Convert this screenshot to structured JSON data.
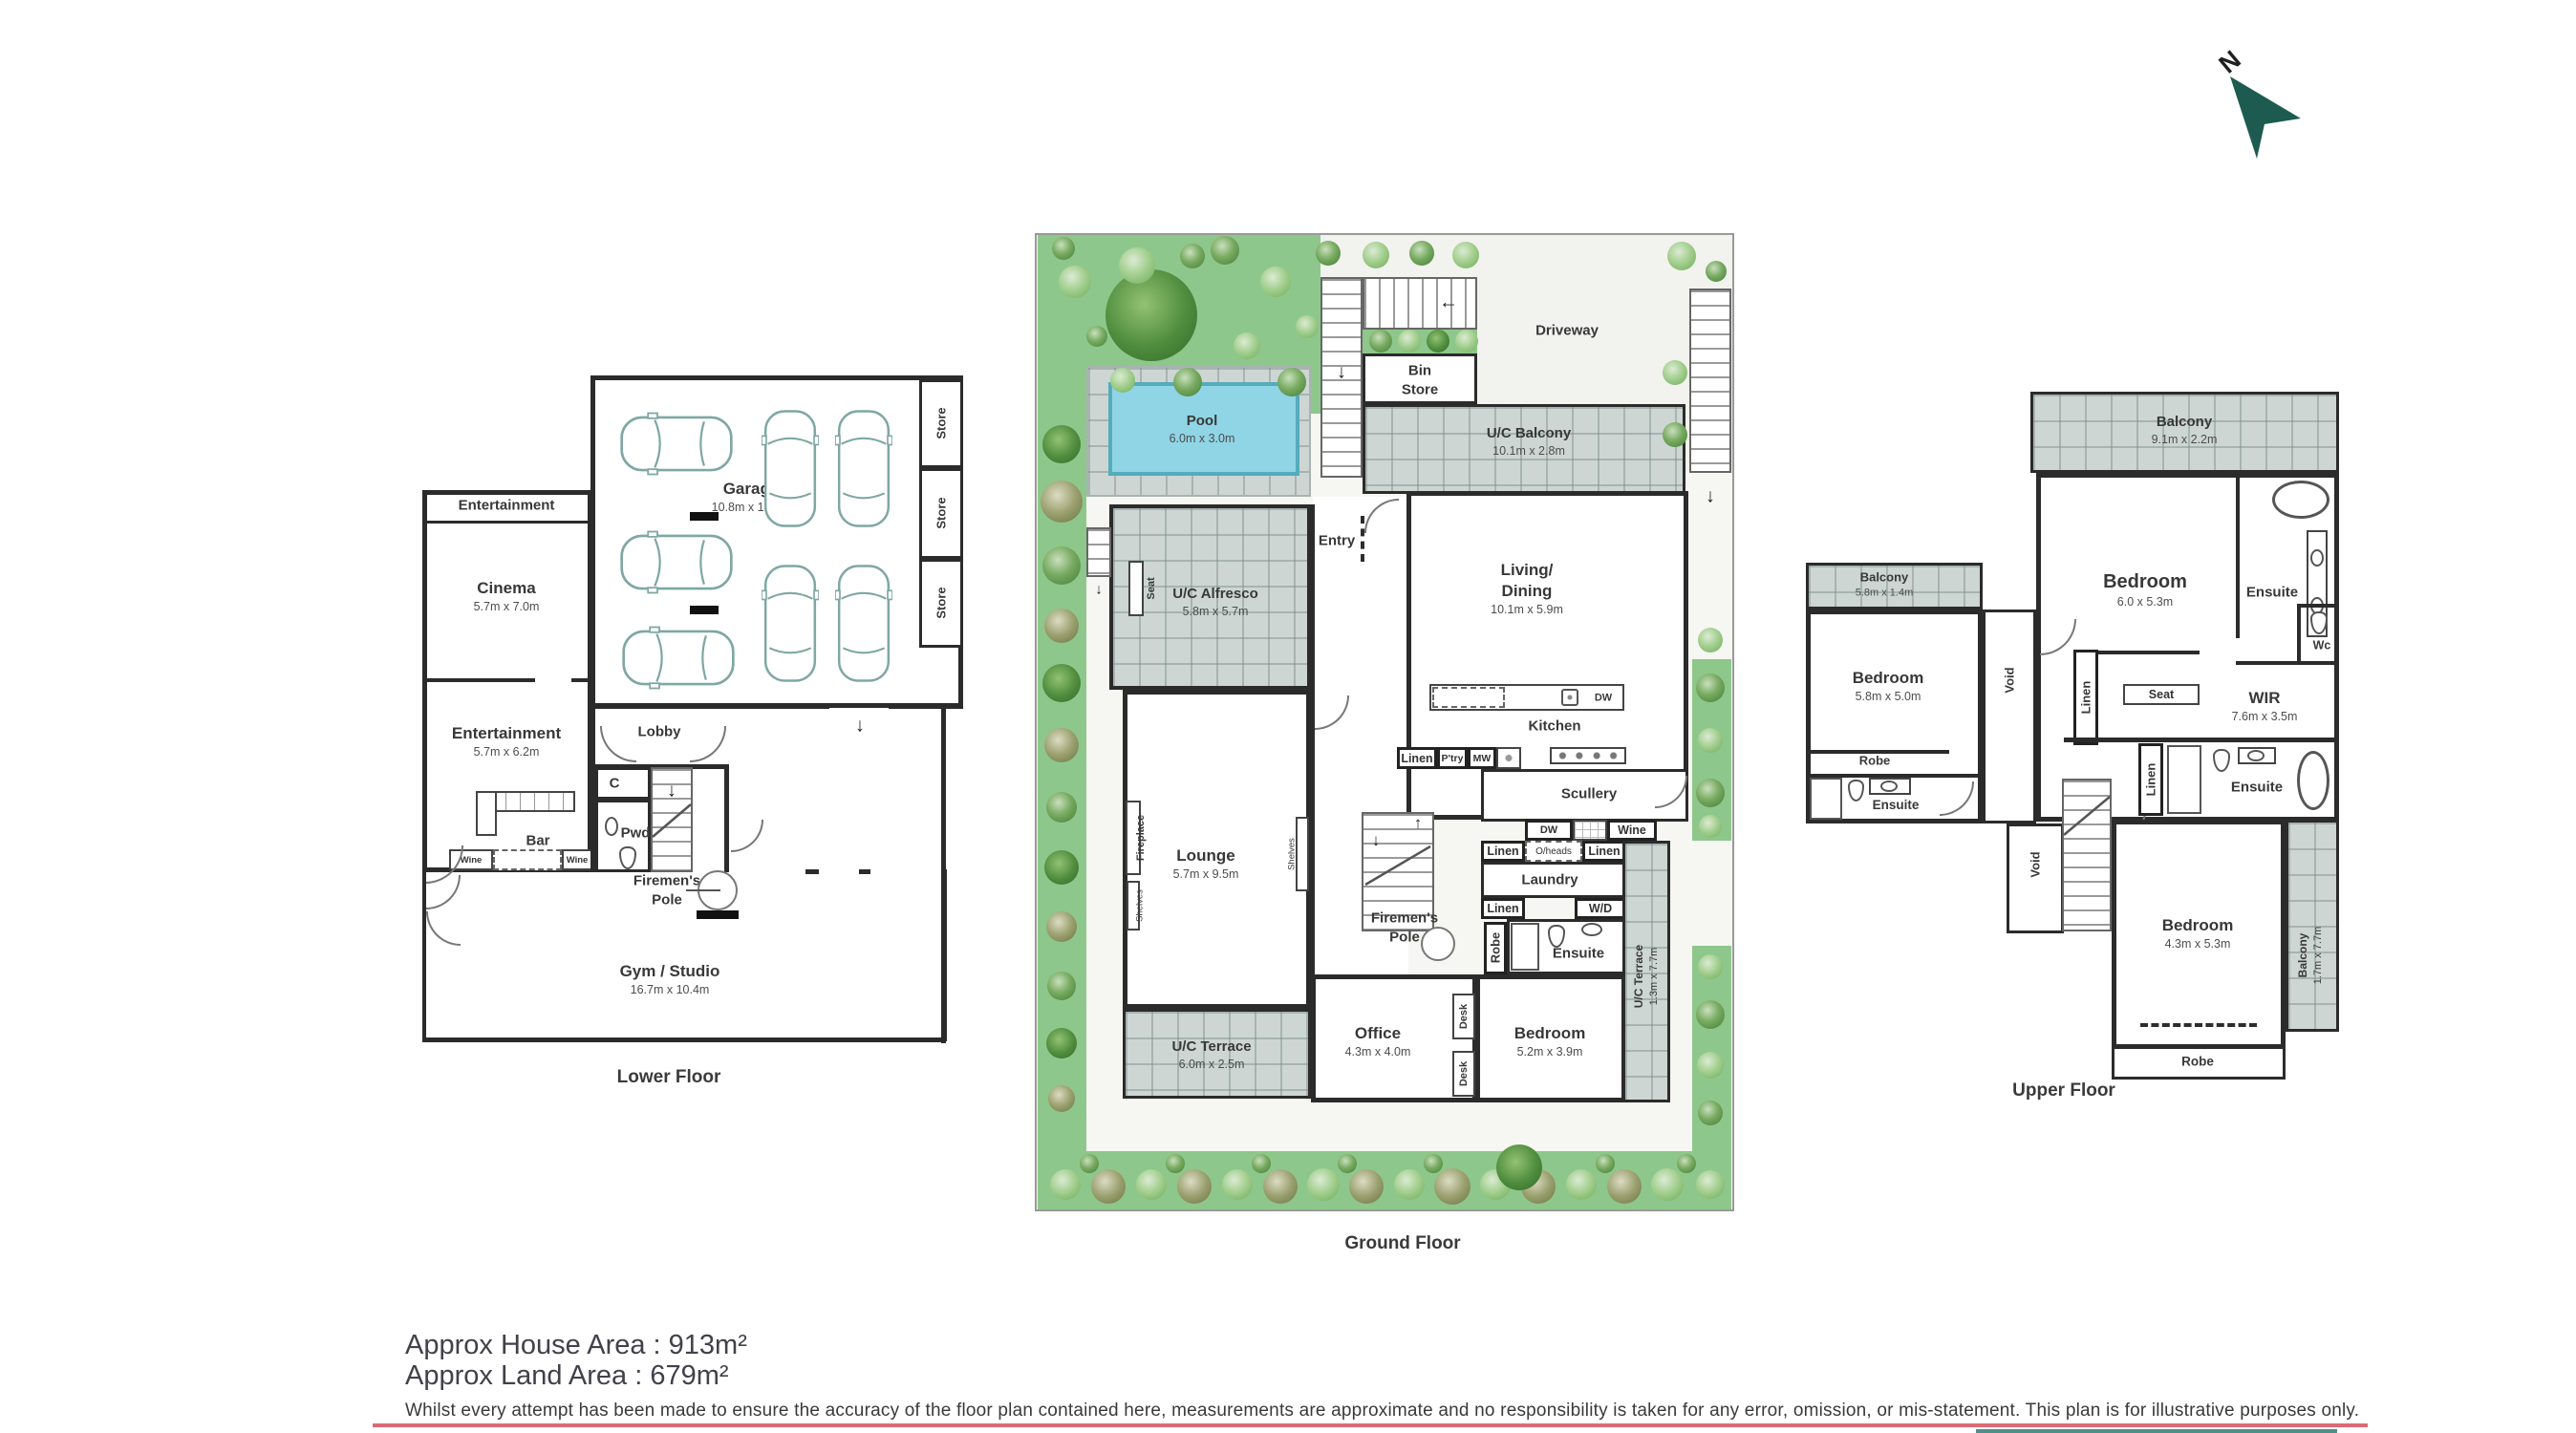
{
  "north_arrow": {
    "letter": "N",
    "color": "#1d5b50"
  },
  "lower_floor": {
    "caption": "Lower Floor",
    "entertainment_upper": {
      "name": "Entertainment"
    },
    "cinema": {
      "name": "Cinema",
      "dims": "5.7m x 7.0m"
    },
    "garage": {
      "name": "Garage",
      "dims": "10.8m x 10.6m"
    },
    "store": "Store",
    "lobby": "Lobby",
    "closet": "C",
    "powder": "Pwd",
    "bar": "Bar",
    "wine": "Wine",
    "entertainment_lower": {
      "name": "Entertainment",
      "dims": "5.7m x 6.2m"
    },
    "firemens_pole": "Firemen's Pole",
    "gym": {
      "name": "Gym / Studio",
      "dims": "16.7m x 10.4m"
    }
  },
  "ground_floor": {
    "caption": "Ground Floor",
    "driveway": "Driveway",
    "bin_store": "Bin Store",
    "pool": {
      "name": "Pool",
      "dims": "6.0m x 3.0m"
    },
    "uc_balcony": {
      "name": "U/C Balcony",
      "dims": "10.1m x 2.8m"
    },
    "entry": "Entry",
    "seat": "Seat",
    "uc_alfresco": {
      "name": "U/C Alfresco",
      "dims": "5.8m x 5.7m"
    },
    "living_dining": {
      "name": "Living/ Dining",
      "dims": "10.1m x 5.9m"
    },
    "kitchen": "Kitchen",
    "linen": "Linen",
    "pantry": "P'try",
    "microwave": "MW",
    "dishwasher": "DW",
    "scullery": "Scullery",
    "wine": "Wine",
    "overheads": "O/heads",
    "laundry": "Laundry",
    "washer_dryer": "W/D",
    "robe": "Robe",
    "ensuite": "Ensuite",
    "firemens_pole": "Firemen's Pole",
    "lounge": {
      "name": "Lounge",
      "dims": "5.7m x 9.5m"
    },
    "fireplace": "Fireplace",
    "shelves": "Shelves",
    "uc_terrace": {
      "name": "U/C Terrace",
      "dims": "6.0m x 2.5m"
    },
    "office": {
      "name": "Office",
      "dims": "4.3m x 4.0m"
    },
    "desk": "Desk",
    "bedroom": {
      "name": "Bedroom",
      "dims": "5.2m x 3.9m"
    },
    "uc_terrace_side": {
      "name": "U/C Terrace",
      "dims": "1.3m x 7.7m"
    }
  },
  "upper_floor": {
    "caption": "Upper Floor",
    "balcony_rear": {
      "name": "Balcony",
      "dims": "9.1m x 2.2m"
    },
    "bedroom_master": {
      "name": "Bedroom",
      "dims": "6.0 x 5.3m"
    },
    "ensuite": "Ensuite",
    "wc": "Wc",
    "wir": {
      "name": "WIR",
      "dims": "7.6m x 3.5m"
    },
    "seat": "Seat",
    "linen": "Linen",
    "void": "Void",
    "balcony_left": {
      "name": "Balcony",
      "dims": "5.8m x 1.4m"
    },
    "bedroom_2": {
      "name": "Bedroom",
      "dims": "5.8m x 5.0m"
    },
    "robe": "Robe",
    "bedroom_3": {
      "name": "Bedroom",
      "dims": "4.3m x 5.3m"
    },
    "balcony_side": {
      "name": "Balcony",
      "dims": "1.7m x 7.7m"
    }
  },
  "footer": {
    "house_area": "Approx House Area : 913m²",
    "land_area": "Approx Land Area : 679m²",
    "disclaimer": "Whilst every attempt has been made to ensure the accuracy of the floor plan contained here, measurements are approximate and no responsibility is taken for any error, omission, or mis-statement. This plan is for illustrative purposes only."
  },
  "colors": {
    "wall": "#2b2b2b",
    "garden": "#8ec78b",
    "tile": "#cdd6d3",
    "pool": "#8fd5e5",
    "north_arrow": "#1d5b50",
    "accent_pink": "#dd6b75",
    "accent_teal": "#4f8f89"
  }
}
